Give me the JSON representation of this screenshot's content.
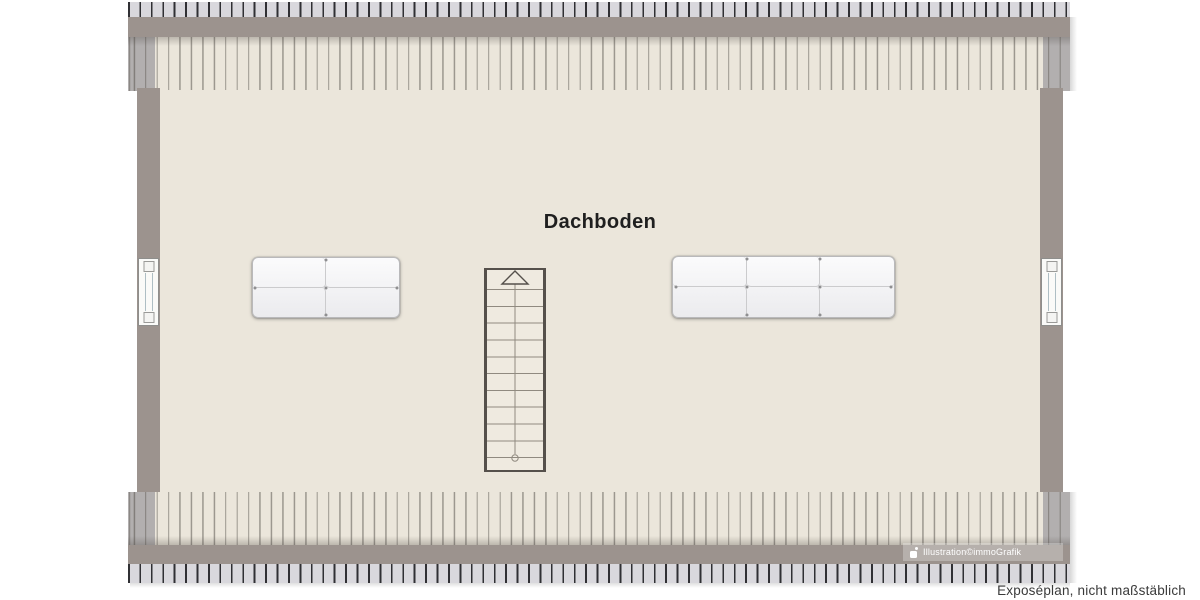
{
  "meta": {
    "floor_label": "Dachboden",
    "watermark": "Illustration©immoGrafik",
    "disclaimer": "Exposéplan, nicht maßstäblich"
  },
  "plan": {
    "type": "attic-floor-plan",
    "room": {
      "name": "Dachboden"
    },
    "windows": [
      {
        "side": "left"
      },
      {
        "side": "right"
      }
    ],
    "roof": {
      "eaves": [
        "top",
        "bottom"
      ],
      "rafter_stripes": true
    }
  },
  "furniture": {
    "staircase": {
      "kind": "straight-stair",
      "tread_count": 12,
      "direction": "up",
      "walk_line": true
    },
    "mattress_left": {
      "kind": "mattress",
      "cols": 2,
      "rows": 2
    },
    "mattress_right": {
      "kind": "mattress",
      "cols": 3,
      "rows": 2
    }
  },
  "colors": {
    "background": "#FFFFFF",
    "floor": "#EBE6DB",
    "wall": "#9C938E",
    "rafter_fill": "#D9D8DD",
    "rafter_line": "#303034",
    "ceiling_line": "#8F8A80",
    "stair_border": "#55504B",
    "stair_tread": "#908A80",
    "mattress_fill": "#F7F7F8",
    "title_text": "#1F1F1F",
    "disclaimer_text": "#3A3A3A",
    "watermark_text": "#FFFFFF"
  }
}
